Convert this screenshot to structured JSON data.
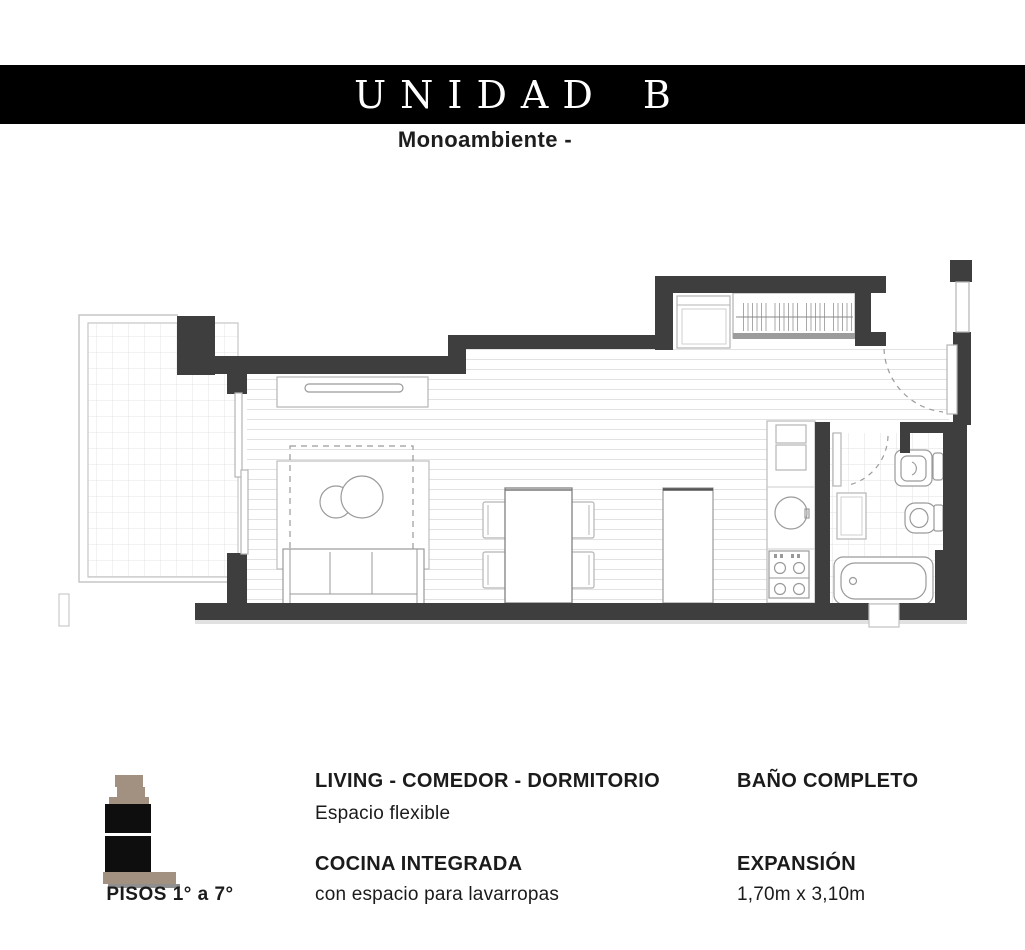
{
  "header": {
    "title": "UNIDAD B",
    "subtitle": "Monoambiente -"
  },
  "features": {
    "living_title": "LIVING - COMEDOR - DORMITORIO",
    "living_sub": "Espacio flexible",
    "kitchen_title": "COCINA INTEGRADA",
    "kitchen_sub": "con espacio para lavarropas",
    "bath_title": "BAÑO COMPLETO",
    "expansion_title": "EXPANSIÓN",
    "expansion_sub": "1,70m x 3,10m"
  },
  "plan": {
    "floors_label": "PISOS 1° a 7°"
  },
  "colors": {
    "wall": "#3e3e3e",
    "header_bg": "#000000",
    "header_text": "#ffffff",
    "text": "#1b1b1b",
    "icon_tan": "#a29181",
    "icon_black": "#0e0e0e",
    "floor_line": "#e2e2e2",
    "fixture_stroke": "#9a9a9a"
  }
}
